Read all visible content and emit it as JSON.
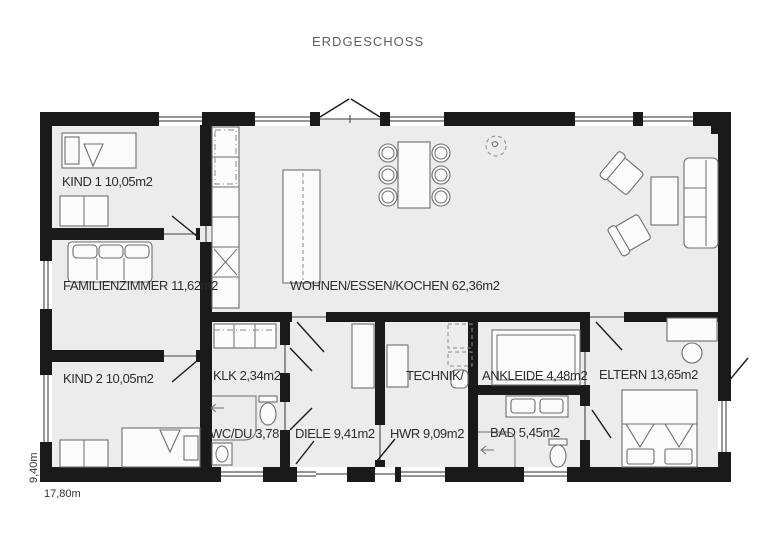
{
  "title": "ERDGESCHOSS",
  "dimensions": {
    "width_label": "17,80m",
    "height_label": "9,40m"
  },
  "rooms": {
    "kind1": "KIND 1 10,05m2",
    "familienzimmer": "FAMILIENZIMMER 11,62m2",
    "kind2": "KIND 2 10,05m2",
    "wohnen": "WOHNEN/ESSEN/KOCHEN 62,36m2",
    "klk": "KLK 2,34m2",
    "technik": "TECHNIK/",
    "hwr": "HWR 9,09m2",
    "ankleide": "ANKLEIDE 4,48m2",
    "eltern": "ELTERN 13,65m2",
    "wcdu": "WC/DU 3,78",
    "diele": "DIELE 9,41m2",
    "bad": "BAD 5,45m2"
  },
  "colors": {
    "wall": "#1a1a1a",
    "floor": "#ececec",
    "label": "#2d2d2d",
    "title": "#5f5f5f"
  }
}
